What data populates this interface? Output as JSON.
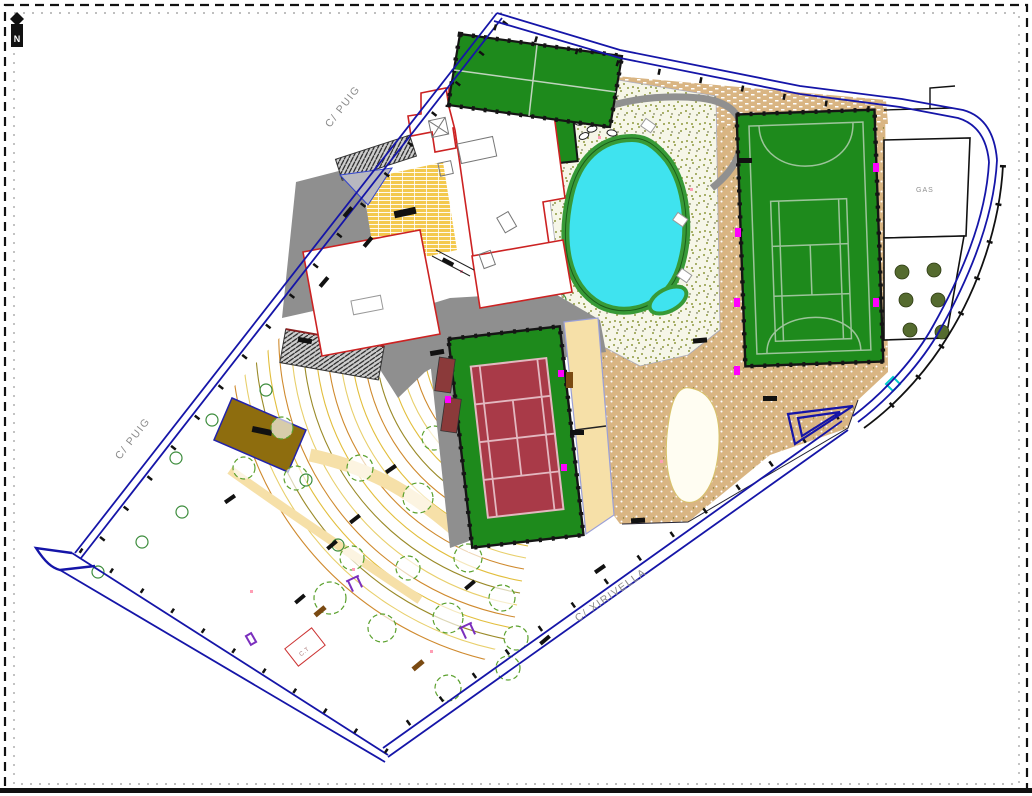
{
  "plan": {
    "labels": {
      "north": "N",
      "puig_upper": "C/ PUIG",
      "puig_lower": "C/ PUIG",
      "xirivella": "C/ XIRIVELLA",
      "gas": "GAS",
      "ct": "C.T"
    },
    "colors": {
      "boundary_blue": "#1515A8",
      "building_red": "#CC2222",
      "court_green": "#1E8A1C",
      "clay_red": "#A93A48",
      "court_line": "#9CC49A",
      "pool_cyan": "#3FE3EF",
      "pool_ring_green": "#379A37",
      "paving_tan": "#D9B583",
      "plaza_yellow": "#F3C94F",
      "path_cream": "#F6E0A8",
      "dirt_brown": "#8E6D0E",
      "speckle_bg": "#F6F6E8",
      "speckle_dot": "#8F9A40",
      "contour_yellow": "#E2BE3C",
      "contour_orange": "#CF8A2E",
      "contour_olive": "#9A8A28",
      "contour_pale": "#E8CF6B",
      "tree_green": "#55A02C",
      "equip_purple": "#7B2FBE",
      "marker_magenta": "#FF00FF",
      "gray_paving": "#8F8F8F",
      "olive_tree": "#556B2F",
      "cyan_marker": "#00CCCC"
    }
  }
}
